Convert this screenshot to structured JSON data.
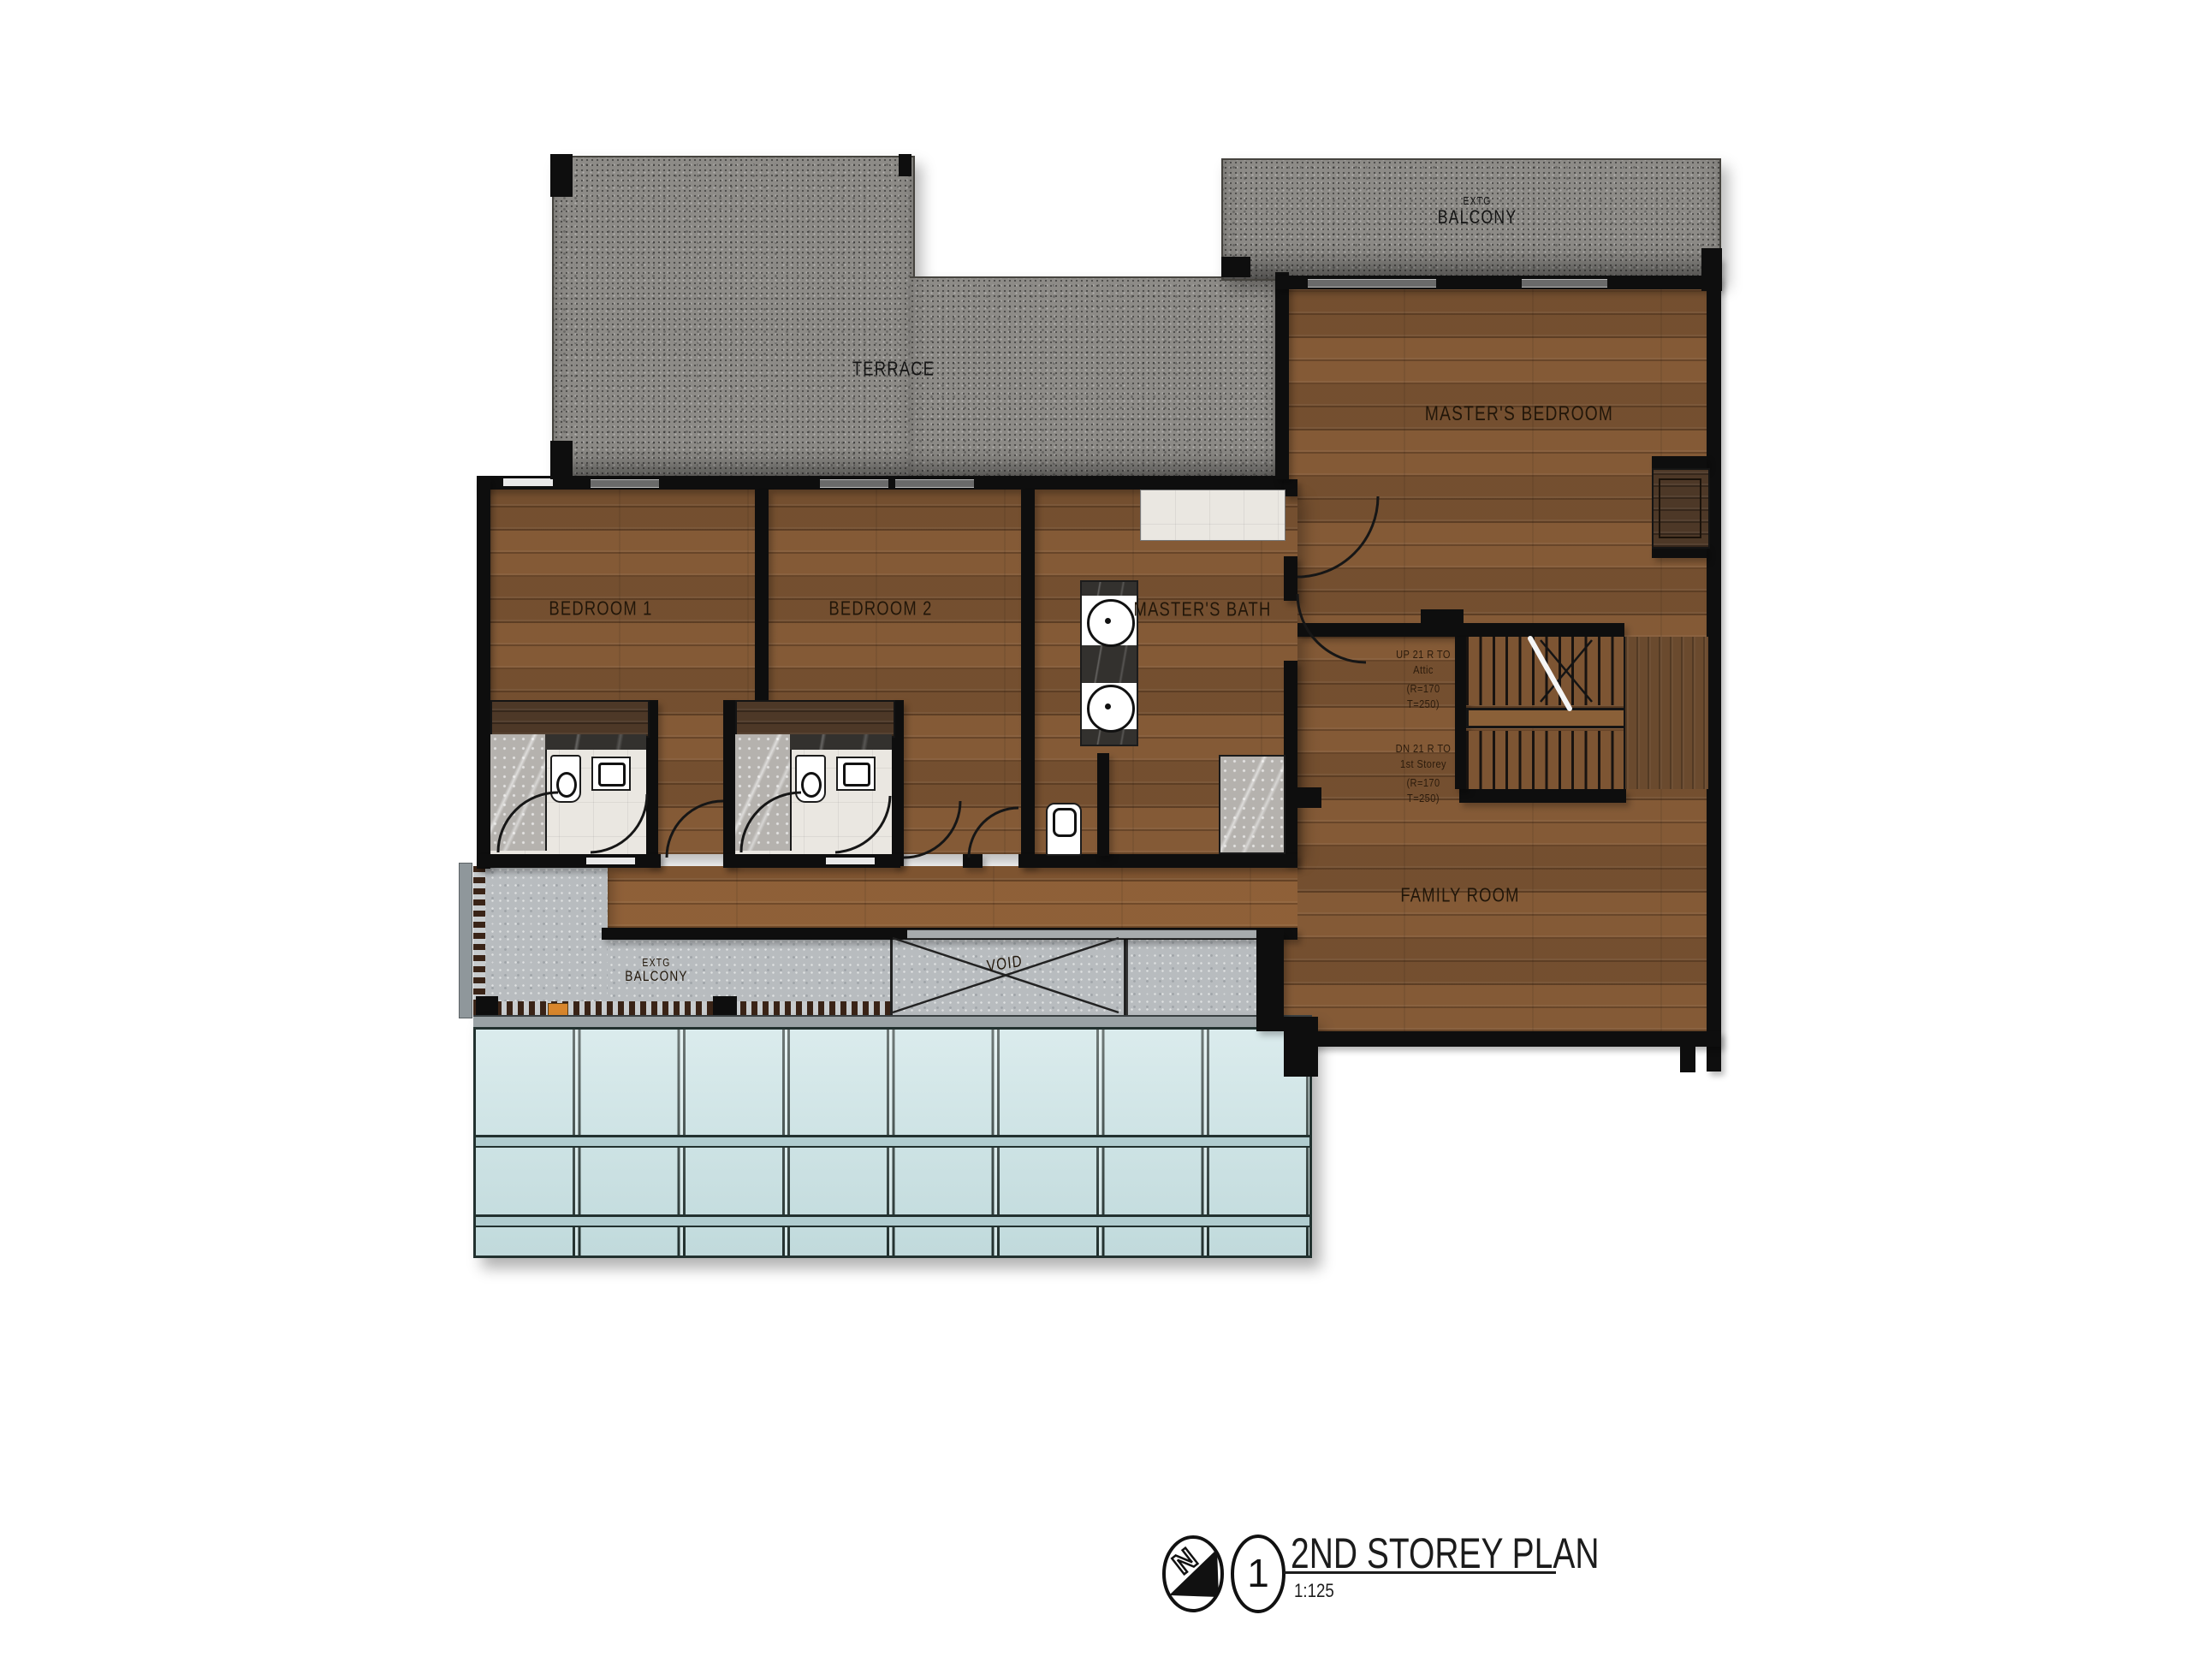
{
  "plan": {
    "title": "2ND STOREY PLAN",
    "scale": "1:125",
    "sheet_number": "1",
    "north_label": "N"
  },
  "rooms": {
    "terrace": "TERRACE",
    "balcony_top": {
      "line1": "EXTG",
      "line2": "BALCONY"
    },
    "master_bedroom": "MASTER'S BEDROOM",
    "bedroom1": "BEDROOM 1",
    "bedroom2": "BEDROOM 2",
    "master_bath": "MASTER'S BATH",
    "family_room": "FAMILY ROOM",
    "balcony_bottom": {
      "line1": "EXTG",
      "line2": "BALCONY"
    },
    "void": "VOID"
  },
  "stairs": {
    "up": [
      "UP 21 R TO",
      "Attic",
      "(R=170",
      "T=250)"
    ],
    "down": [
      "DN 21 R TO",
      "1st Storey",
      "(R=170",
      "T=250)"
    ]
  },
  "colors": {
    "wall": "#0e0e0e",
    "wood": "#7d5533",
    "stone": "#8d8b87",
    "concrete": "#b8bcbf",
    "glass": "#c7e1e3",
    "accent_orange": "#d8862c"
  }
}
